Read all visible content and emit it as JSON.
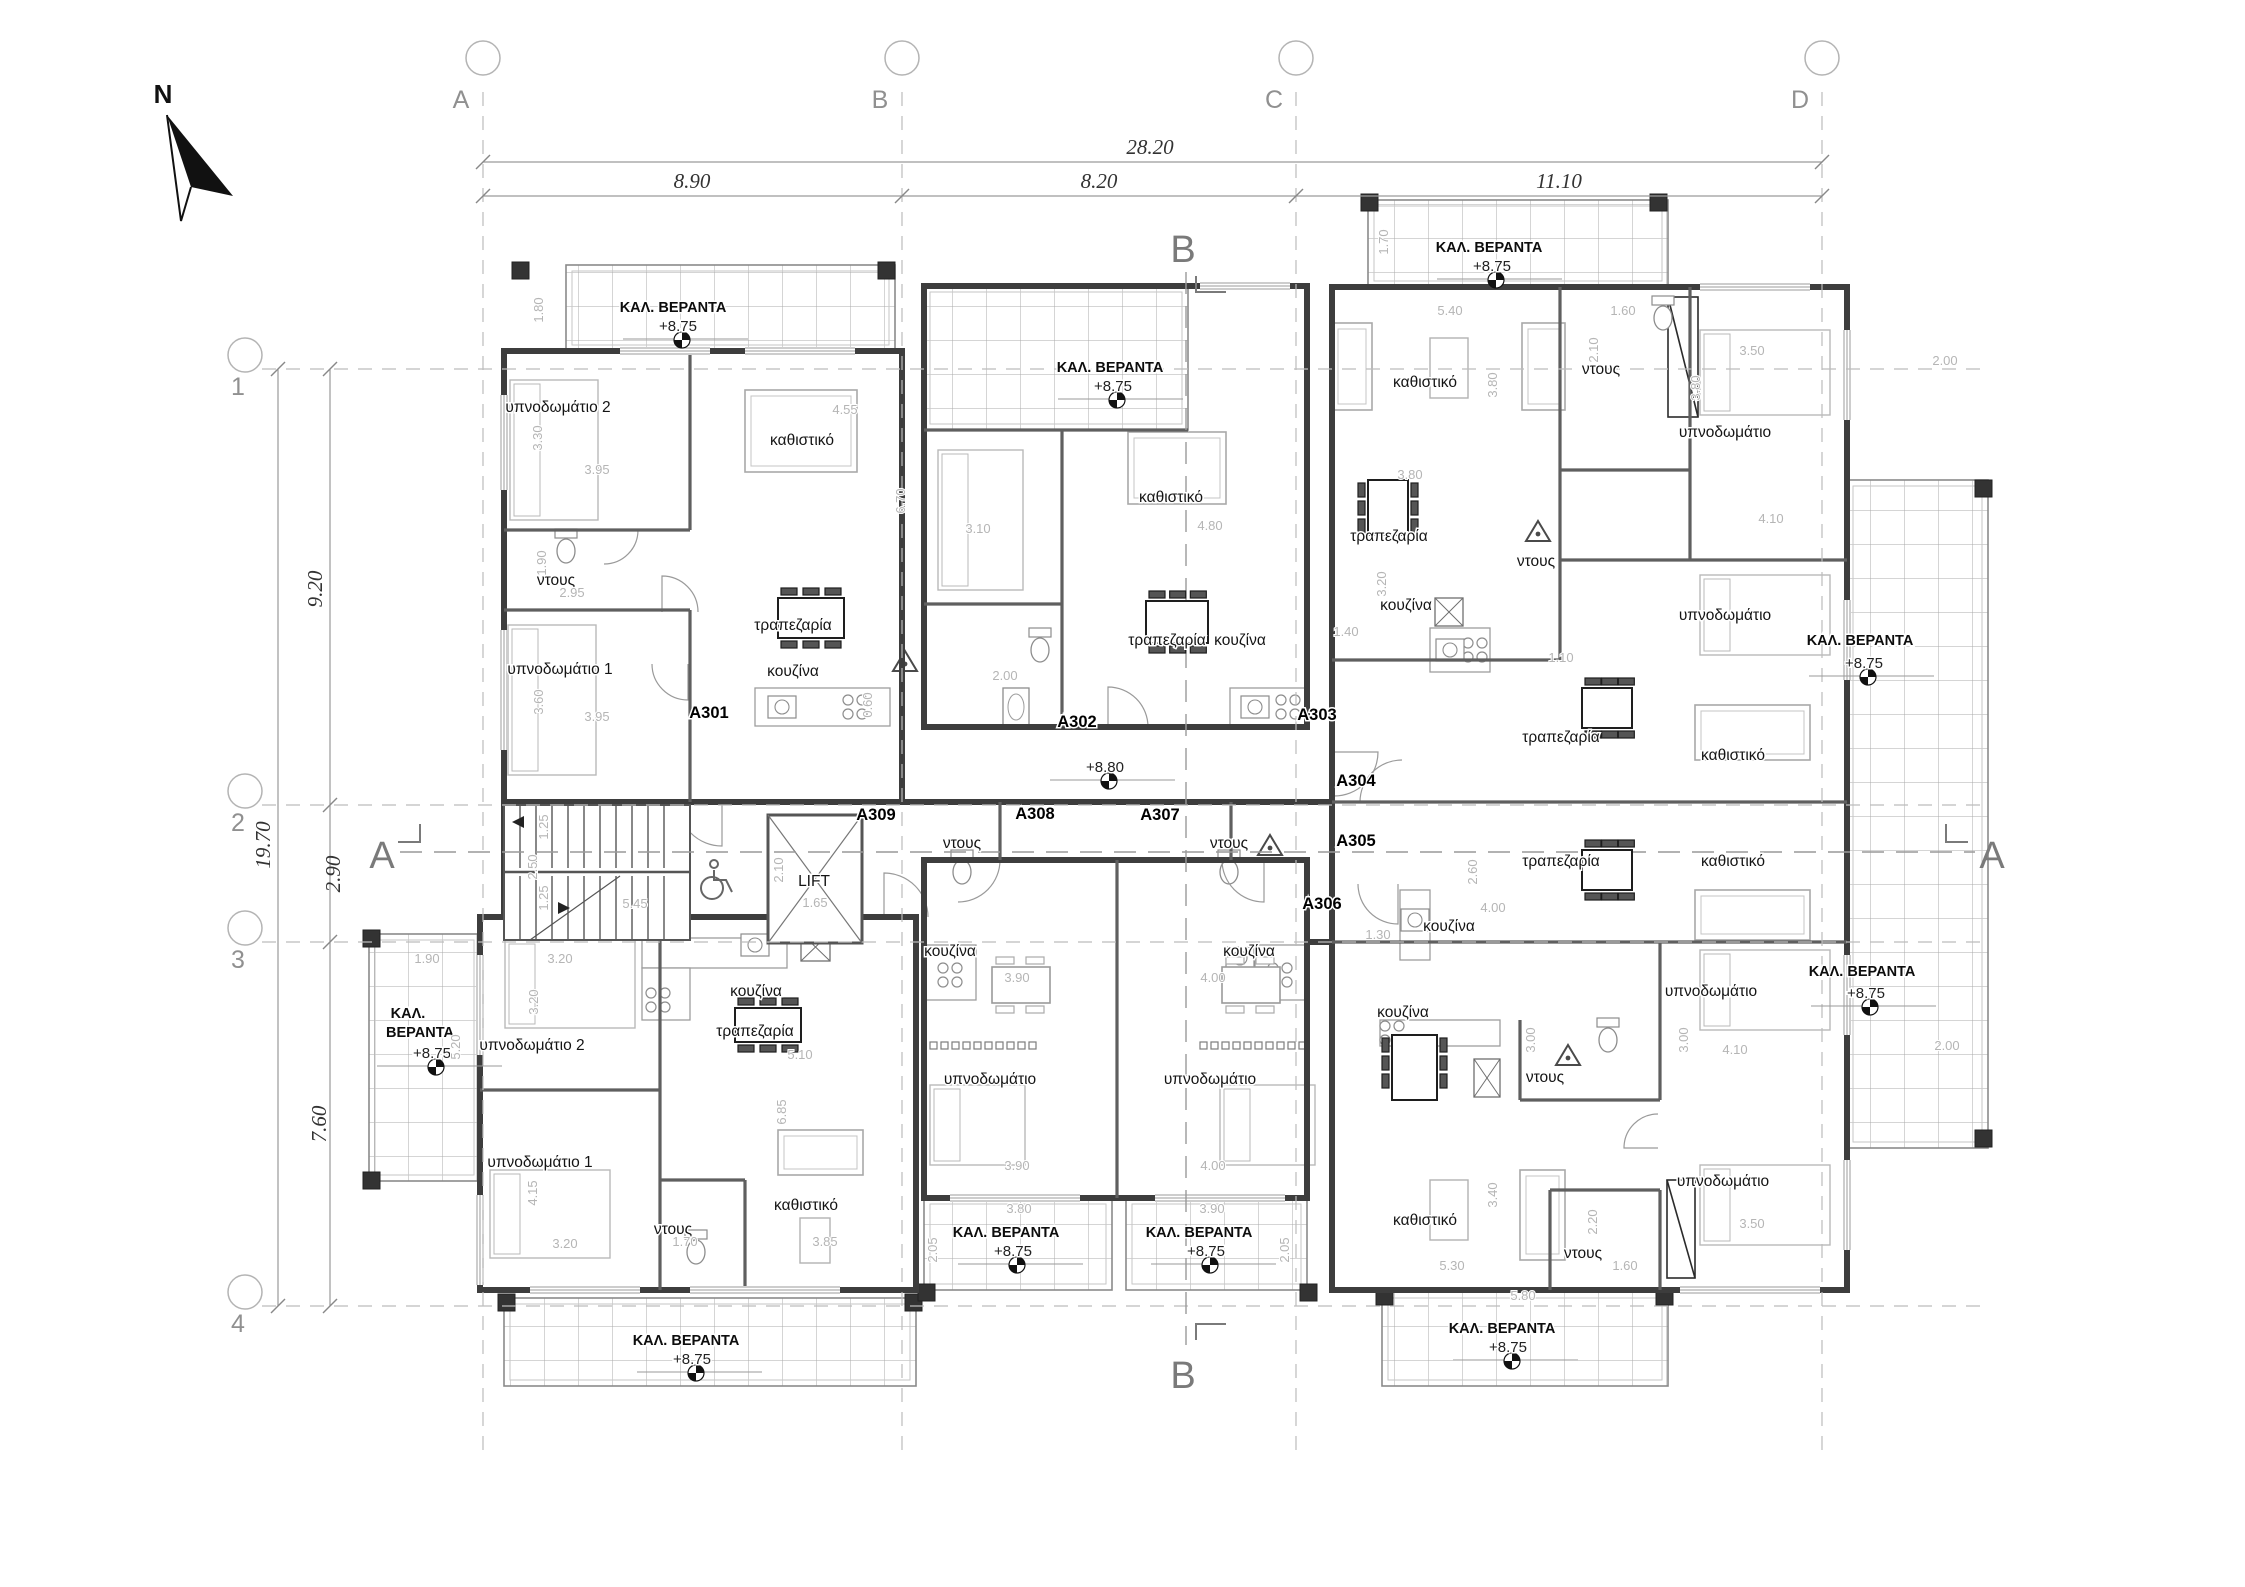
{
  "north": {
    "label": "N"
  },
  "grid": {
    "columns": [
      {
        "label": "A",
        "x": 483
      },
      {
        "label": "B",
        "x": 902
      },
      {
        "label": "C",
        "x": 1296
      },
      {
        "label": "D",
        "x": 1822
      }
    ],
    "rows": [
      {
        "label": "1",
        "y": 369
      },
      {
        "label": "2",
        "y": 805
      },
      {
        "label": "3",
        "y": 942
      },
      {
        "label": "4",
        "y": 1306
      }
    ]
  },
  "dimensions": {
    "horizontal": {
      "total": {
        "text": "28.20",
        "x": 1150,
        "y": 154
      },
      "segments": [
        {
          "text": "8.90",
          "x": 692,
          "y": 188
        },
        {
          "text": "8.20",
          "x": 1099,
          "y": 188
        },
        {
          "text": "11.10",
          "x": 1559,
          "y": 188
        }
      ]
    },
    "vertical": {
      "total": {
        "text": "19.70",
        "x": 270,
        "y": 845
      },
      "segments": [
        {
          "text": "9.20",
          "x": 322,
          "y": 589
        },
        {
          "text": "2.90",
          "x": 340,
          "y": 874
        },
        {
          "text": "7.60",
          "x": 326,
          "y": 1124
        }
      ]
    }
  },
  "sections": {
    "top": {
      "label": "B",
      "x": 1183,
      "y": 262
    },
    "bottom": {
      "label": "B",
      "x": 1183,
      "y": 1388
    },
    "left": {
      "label": "A",
      "x": 382,
      "y": 868
    },
    "right": {
      "label": "A",
      "x": 1992,
      "y": 868
    }
  },
  "apartment_codes": [
    {
      "t": "A301",
      "x": 709,
      "y": 718
    },
    {
      "t": "A302",
      "x": 1077,
      "y": 727
    },
    {
      "t": "A303",
      "x": 1317,
      "y": 720
    },
    {
      "t": "A304",
      "x": 1356,
      "y": 786
    },
    {
      "t": "A305",
      "x": 1356,
      "y": 846
    },
    {
      "t": "A306",
      "x": 1322,
      "y": 909
    },
    {
      "t": "A307",
      "x": 1160,
      "y": 820
    },
    {
      "t": "A308",
      "x": 1035,
      "y": 819
    },
    {
      "t": "A309",
      "x": 876,
      "y": 820
    }
  ],
  "room_labels": [
    {
      "t": "υπνοδωμάτιο 2",
      "x": 558,
      "y": 412
    },
    {
      "t": "καθιστικό",
      "x": 802,
      "y": 445
    },
    {
      "t": "ντους",
      "x": 556,
      "y": 585
    },
    {
      "t": "υπνοδωμάτιο 1",
      "x": 560,
      "y": 674
    },
    {
      "t": "τραπεζαρία",
      "x": 793,
      "y": 630
    },
    {
      "t": "κουζίνα",
      "x": 793,
      "y": 676
    },
    {
      "t": "καθιστικό",
      "x": 1171,
      "y": 502
    },
    {
      "t": "τραπεζαρία",
      "x": 1167,
      "y": 645
    },
    {
      "t": "κουζίνα",
      "x": 1240,
      "y": 645
    },
    {
      "t": "καθιστικό",
      "x": 1425,
      "y": 387
    },
    {
      "t": "ντους",
      "x": 1601,
      "y": 374
    },
    {
      "t": "υπνοδωμάτιο",
      "x": 1725,
      "y": 437
    },
    {
      "t": "τραπεζαρία",
      "x": 1389,
      "y": 541
    },
    {
      "t": "ντους",
      "x": 1536,
      "y": 566
    },
    {
      "t": "κουζίνα",
      "x": 1406,
      "y": 610
    },
    {
      "t": "υπνοδωμάτιο",
      "x": 1725,
      "y": 620
    },
    {
      "t": "τραπεζαρία",
      "x": 1561,
      "y": 742
    },
    {
      "t": "καθιστικό",
      "x": 1733,
      "y": 760
    },
    {
      "t": "τραπεζαρία",
      "x": 1561,
      "y": 866
    },
    {
      "t": "καθιστικό",
      "x": 1733,
      "y": 866
    },
    {
      "t": "κουζίνα",
      "x": 1449,
      "y": 931
    },
    {
      "t": "υπνοδωμάτιο",
      "x": 1711,
      "y": 996
    },
    {
      "t": "κουζίνα",
      "x": 1403,
      "y": 1017
    },
    {
      "t": "ντους",
      "x": 1545,
      "y": 1082
    },
    {
      "t": "καθιστικό",
      "x": 1425,
      "y": 1225
    },
    {
      "t": "ντους",
      "x": 1583,
      "y": 1258
    },
    {
      "t": "υπνοδωμάτιο",
      "x": 1723,
      "y": 1186
    },
    {
      "t": "ντους",
      "x": 962,
      "y": 848
    },
    {
      "t": "ντους",
      "x": 1229,
      "y": 848
    },
    {
      "t": "κουζίνα",
      "x": 950,
      "y": 956
    },
    {
      "t": "κουζίνα",
      "x": 1249,
      "y": 956
    },
    {
      "t": "υπνοδωμάτιο",
      "x": 990,
      "y": 1084
    },
    {
      "t": "υπνοδωμάτιο",
      "x": 1210,
      "y": 1084
    },
    {
      "t": "LIFT",
      "x": 814,
      "y": 886
    },
    {
      "t": "υπνοδωμάτιο 2",
      "x": 532,
      "y": 1050
    },
    {
      "t": "κουζίνα",
      "x": 756,
      "y": 996
    },
    {
      "t": "τραπεζαρία",
      "x": 755,
      "y": 1036
    },
    {
      "t": "υπνοδωμάτιο 1",
      "x": 540,
      "y": 1167
    },
    {
      "t": "ντους",
      "x": 673,
      "y": 1234
    },
    {
      "t": "καθιστικό",
      "x": 806,
      "y": 1210
    }
  ],
  "veranda_labels": [
    {
      "t": "ΚΑΛ. ΒΕΡΑΝΤΑ",
      "x": 673,
      "y": 312
    },
    {
      "t": "ΚΑΛ. ΒΕΡΑΝΤΑ",
      "x": 1110,
      "y": 372
    },
    {
      "t": "ΚΑΛ. ΒΕΡΑΝΤΑ",
      "x": 1489,
      "y": 252
    },
    {
      "t": "ΚΑΛ. ΒΕΡΑΝΤΑ",
      "x": 1860,
      "y": 645
    },
    {
      "t": "ΚΑΛ. ΒΕΡΑΝΤΑ",
      "x": 1862,
      "y": 976
    },
    {
      "t": "ΚΑΛ.",
      "x": 408,
      "y": 1018
    },
    {
      "t": "ΒΕΡΑΝΤΑ",
      "x": 420,
      "y": 1037
    },
    {
      "t": "ΚΑΛ. ΒΕΡΑΝΤΑ",
      "x": 686,
      "y": 1345
    },
    {
      "t": "ΚΑΛ. ΒΕΡΑΝΤΑ",
      "x": 1006,
      "y": 1237
    },
    {
      "t": "ΚΑΛ. ΒΕΡΑΝΤΑ",
      "x": 1199,
      "y": 1237
    },
    {
      "t": "ΚΑΛ. ΒΕΡΑΝΤΑ",
      "x": 1502,
      "y": 1333
    }
  ],
  "level_labels": [
    {
      "t": "+8.75",
      "x": 678,
      "y": 331
    },
    {
      "t": "+8.75",
      "x": 1113,
      "y": 391
    },
    {
      "t": "+8.75",
      "x": 1492,
      "y": 271
    },
    {
      "t": "+8.75",
      "x": 1864,
      "y": 668
    },
    {
      "t": "+8.75",
      "x": 1866,
      "y": 998
    },
    {
      "t": "+8.75",
      "x": 432,
      "y": 1058
    },
    {
      "t": "+8.75",
      "x": 692,
      "y": 1364
    },
    {
      "t": "+8.75",
      "x": 1013,
      "y": 1256
    },
    {
      "t": "+8.75",
      "x": 1206,
      "y": 1256
    },
    {
      "t": "+8.75",
      "x": 1508,
      "y": 1352
    },
    {
      "t": "+8.80",
      "x": 1105,
      "y": 772
    }
  ],
  "small_dims": [
    {
      "t": "1.80",
      "x": 543,
      "y": 310,
      "r": 1
    },
    {
      "t": "3.30",
      "x": 542,
      "y": 438,
      "r": 1
    },
    {
      "t": "3.95",
      "x": 597,
      "y": 474
    },
    {
      "t": "4.55",
      "x": 845,
      "y": 414
    },
    {
      "t": "6.70",
      "x": 905,
      "y": 501,
      "r": 1
    },
    {
      "t": "1.90",
      "x": 546,
      "y": 563,
      "r": 1
    },
    {
      "t": "2.95",
      "x": 572,
      "y": 597
    },
    {
      "t": "3.60",
      "x": 543,
      "y": 702,
      "r": 1
    },
    {
      "t": "3.95",
      "x": 597,
      "y": 721
    },
    {
      "t": "3.10",
      "x": 978,
      "y": 533
    },
    {
      "t": "4.80",
      "x": 1210,
      "y": 530
    },
    {
      "t": "2.00",
      "x": 1005,
      "y": 680
    },
    {
      "t": "0.60",
      "x": 872,
      "y": 705,
      "r": 1
    },
    {
      "t": "5.40",
      "x": 1450,
      "y": 315
    },
    {
      "t": "3.80",
      "x": 1497,
      "y": 385,
      "r": 1
    },
    {
      "t": "1.60",
      "x": 1623,
      "y": 315
    },
    {
      "t": "2.10",
      "x": 1598,
      "y": 350,
      "r": 1
    },
    {
      "t": "3.50",
      "x": 1752,
      "y": 355
    },
    {
      "t": "3.80",
      "x": 1700,
      "y": 388,
      "r": 1
    },
    {
      "t": "2.00",
      "x": 1945,
      "y": 365
    },
    {
      "t": "1.70",
      "x": 1388,
      "y": 242,
      "r": 1
    },
    {
      "t": "3.80",
      "x": 1410,
      "y": 479
    },
    {
      "t": "4.10",
      "x": 1771,
      "y": 523
    },
    {
      "t": "3.20",
      "x": 1386,
      "y": 584,
      "r": 1
    },
    {
      "t": "1.40",
      "x": 1346,
      "y": 636
    },
    {
      "t": "1.10",
      "x": 1561,
      "y": 662
    },
    {
      "t": "2.60",
      "x": 1477,
      "y": 872,
      "r": 1
    },
    {
      "t": "4.00",
      "x": 1493,
      "y": 912
    },
    {
      "t": "1.30",
      "x": 1378,
      "y": 939
    },
    {
      "t": "5.45",
      "x": 635,
      "y": 908
    },
    {
      "t": "2.50",
      "x": 537,
      "y": 867,
      "r": 1
    },
    {
      "t": "1.25",
      "x": 548,
      "y": 827,
      "r": 1
    },
    {
      "t": "1.25",
      "x": 548,
      "y": 898,
      "r": 1
    },
    {
      "t": "1.65",
      "x": 815,
      "y": 907
    },
    {
      "t": "2.10",
      "x": 783,
      "y": 870,
      "r": 1
    },
    {
      "t": "3.90",
      "x": 1017,
      "y": 982
    },
    {
      "t": "4.00",
      "x": 1213,
      "y": 982
    },
    {
      "t": "3.90",
      "x": 1017,
      "y": 1170
    },
    {
      "t": "4.00",
      "x": 1213,
      "y": 1170
    },
    {
      "t": "3.80",
      "x": 1019,
      "y": 1213
    },
    {
      "t": "3.90",
      "x": 1212,
      "y": 1213
    },
    {
      "t": "2.05",
      "x": 937,
      "y": 1250,
      "r": 1
    },
    {
      "t": "2.05",
      "x": 1289,
      "y": 1250,
      "r": 1
    },
    {
      "t": "3.20",
      "x": 560,
      "y": 963
    },
    {
      "t": "3.20",
      "x": 538,
      "y": 1002,
      "r": 1
    },
    {
      "t": "5.20",
      "x": 460,
      "y": 1047,
      "r": 1
    },
    {
      "t": "1.90",
      "x": 427,
      "y": 963
    },
    {
      "t": "4.15",
      "x": 537,
      "y": 1193,
      "r": 1
    },
    {
      "t": "3.20",
      "x": 565,
      "y": 1248
    },
    {
      "t": "5.10",
      "x": 800,
      "y": 1059
    },
    {
      "t": "6.85",
      "x": 786,
      "y": 1112,
      "r": 1
    },
    {
      "t": "1.70",
      "x": 685,
      "y": 1246
    },
    {
      "t": "3.85",
      "x": 825,
      "y": 1246
    },
    {
      "t": "5.30",
      "x": 1452,
      "y": 1270
    },
    {
      "t": "5.80",
      "x": 1523,
      "y": 1300
    },
    {
      "t": "3.40",
      "x": 1497,
      "y": 1195,
      "r": 1
    },
    {
      "t": "2.20",
      "x": 1597,
      "y": 1222,
      "r": 1
    },
    {
      "t": "1.60",
      "x": 1625,
      "y": 1270
    },
    {
      "t": "3.50",
      "x": 1752,
      "y": 1228
    },
    {
      "t": "3.00",
      "x": 1535,
      "y": 1040,
      "r": 1
    },
    {
      "t": "3.00",
      "x": 1688,
      "y": 1040,
      "r": 1
    },
    {
      "t": "4.10",
      "x": 1735,
      "y": 1054
    },
    {
      "t": "2.00",
      "x": 1947,
      "y": 1050
    }
  ],
  "colors": {
    "wall": "#3d3d3d",
    "partition": "#5f5f5f",
    "furniture": "#b9b9b9",
    "dark_furniture": "#262626",
    "hatch": "#ababab",
    "grid_dash": "#bcbcbc",
    "dim_text": "#b5b5b5",
    "label": "#111111",
    "section": "#7a7a7a"
  }
}
